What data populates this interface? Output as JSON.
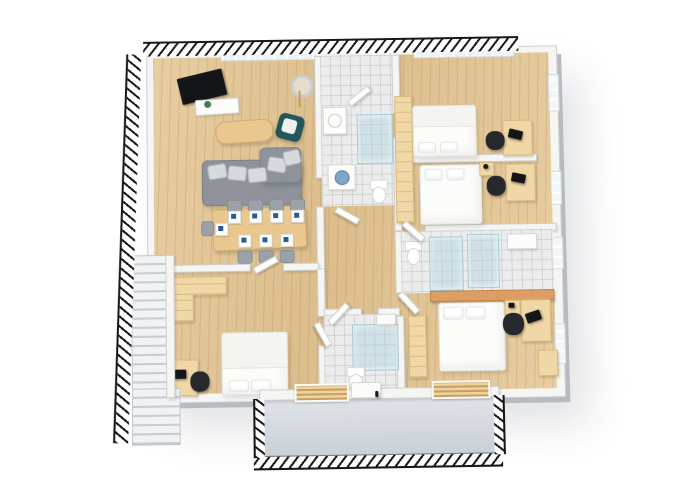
{
  "scene": {
    "title": "3D isometric floor plan of an apartment",
    "view": "isometric 3D render, cut walls shown as black hatching",
    "background": "#ffffff"
  },
  "colors": {
    "wood_floor": "#dcbd8c",
    "wood_floor_light": "#e7cda1",
    "wall": "#f5f5f3",
    "wall_edge": "#cfcfcc",
    "tile": "#ebeceb",
    "glass": "rgba(173,210,224,0.45)",
    "sofa_gray": "#8e939b",
    "cushion": "#d6d9dd",
    "armchair_teal": "#23575c",
    "tan_furniture": "#f0d7a6",
    "table_wood": "#e9c88f",
    "chair_gray": "#9aa1a9",
    "chair_black": "#27282c",
    "bed_white": "#fcfcfa",
    "napkin_blue": "#2a5d8f",
    "balcony_floor": "#c9cfd6",
    "hatch": "#161616",
    "tv_black": "#141517",
    "plant_green": "#3f7d4e",
    "counter_tan": "#dd9e66"
  },
  "rooms": {
    "living_dining": {
      "name": "Living / dining room",
      "furniture": [
        "wall-tv",
        "media-sideboard",
        "plant",
        "floor-lamp",
        "lounge-chair",
        "coffee-table",
        "corner-sofa",
        "sofa-cushions",
        "dining-table",
        "dining-chairs",
        "place-settings"
      ]
    },
    "laundry_bath": {
      "name": "Shower room / laundry",
      "furniture": [
        "sink",
        "glass-shower",
        "washing-machine",
        "toilet"
      ]
    },
    "bedroom_1": {
      "name": "Bedroom 1",
      "furniture": [
        "double-bed",
        "desk",
        "monitor",
        "office-chair",
        "wardrobe"
      ]
    },
    "bedroom_2": {
      "name": "Bedroom 2",
      "furniture": [
        "double-bed",
        "nightstand",
        "desk",
        "monitor",
        "office-chair",
        "wardrobe"
      ]
    },
    "ensuite_bath": {
      "name": "En-suite bathroom",
      "furniture": [
        "toilet",
        "glass-shower",
        "glass-shower-2",
        "sink-cabinet",
        "vanity-counter"
      ]
    },
    "master_bedroom": {
      "name": "Master bedroom",
      "furniture": [
        "double-bed",
        "nightstand",
        "desk",
        "laptop",
        "office-chair",
        "tall-wardrobe",
        "corner-cabinet"
      ]
    },
    "bathroom_2": {
      "name": "Bathroom",
      "furniture": [
        "glass-shower",
        "sink",
        "toilet"
      ]
    },
    "bedroom_3": {
      "name": "Bedroom 3",
      "furniture": [
        "double-bed",
        "desk",
        "laptop",
        "office-chair",
        "l-shaped-wardrobe",
        "wall-shelf"
      ]
    },
    "hallway": {
      "name": "Hallway",
      "furniture": [
        "interior-doors"
      ]
    },
    "staircase": {
      "name": "Staircase",
      "furniture": [
        "stair-flight-upper",
        "stair-flight-lower"
      ]
    },
    "balcony": {
      "name": "Balcony",
      "furniture": [
        "railing",
        "louvered-shutters",
        "balcony-door"
      ]
    }
  },
  "counts": {
    "beds": 4,
    "desks": 4,
    "office_chairs": 4,
    "dining_chairs": 8,
    "place_settings": 8,
    "bathrooms": 3,
    "glass_showers": 4,
    "toilets": 3,
    "washing_machines": 1,
    "balconies": 1
  }
}
